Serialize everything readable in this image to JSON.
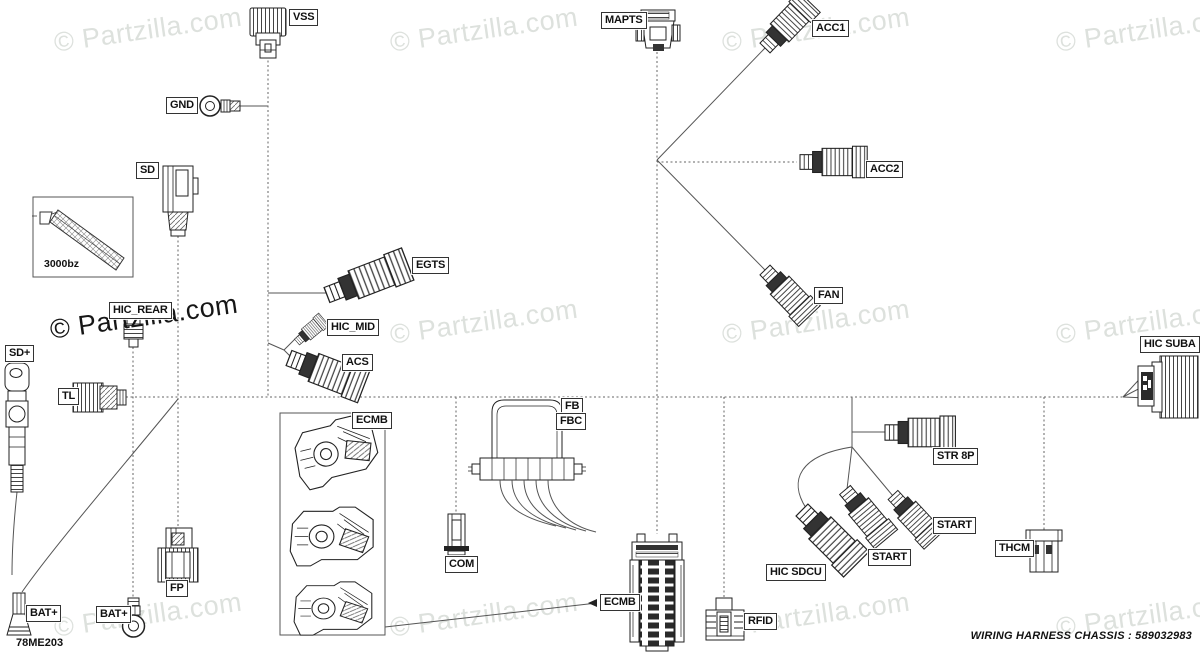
{
  "colors": {
    "background": "#ffffff",
    "line": "#555555",
    "label_border": "#333333",
    "watermark_light": "#dde1dd",
    "watermark_dark": "#161616"
  },
  "watermark": {
    "text": "© Partzilla.com"
  },
  "footer": {
    "code": "78ME203",
    "title": "WIRING HARNESS  CHASSIS",
    "colon": ":",
    "number": "589032983"
  },
  "inset": {
    "caption": "3000bz"
  },
  "labels": [
    {
      "id": "vss",
      "text": "VSS"
    },
    {
      "id": "gnd",
      "text": "GND"
    },
    {
      "id": "sd",
      "text": "SD"
    },
    {
      "id": "hic-rear",
      "text": "HIC_REAR"
    },
    {
      "id": "sd-plus",
      "text": "SD+"
    },
    {
      "id": "tl",
      "text": "TL"
    },
    {
      "id": "egts",
      "text": "EGTS"
    },
    {
      "id": "hic-mid",
      "text": "HIC_MID"
    },
    {
      "id": "acs",
      "text": "ACS"
    },
    {
      "id": "mapts",
      "text": "MAPTS"
    },
    {
      "id": "acc1",
      "text": "ACC1"
    },
    {
      "id": "acc2",
      "text": "ACC2"
    },
    {
      "id": "fan",
      "text": "FAN"
    },
    {
      "id": "hic-suba",
      "text": "HIC SUBA"
    },
    {
      "id": "fb",
      "text": "FB"
    },
    {
      "id": "fbc",
      "text": "FBC"
    },
    {
      "id": "ecmb-box",
      "text": "ECMB"
    },
    {
      "id": "com",
      "text": "COM"
    },
    {
      "id": "fp",
      "text": "FP"
    },
    {
      "id": "bat-plus-1",
      "text": "BAT+"
    },
    {
      "id": "bat-plus-2",
      "text": "BAT+"
    },
    {
      "id": "ecmb",
      "text": "ECMB"
    },
    {
      "id": "rfid",
      "text": "RFID"
    },
    {
      "id": "str-8p",
      "text": "STR 8P"
    },
    {
      "id": "start-1",
      "text": "START"
    },
    {
      "id": "start-2",
      "text": "START"
    },
    {
      "id": "hic-sdcu",
      "text": "HIC SDCU"
    },
    {
      "id": "thcm",
      "text": "THCM"
    }
  ]
}
